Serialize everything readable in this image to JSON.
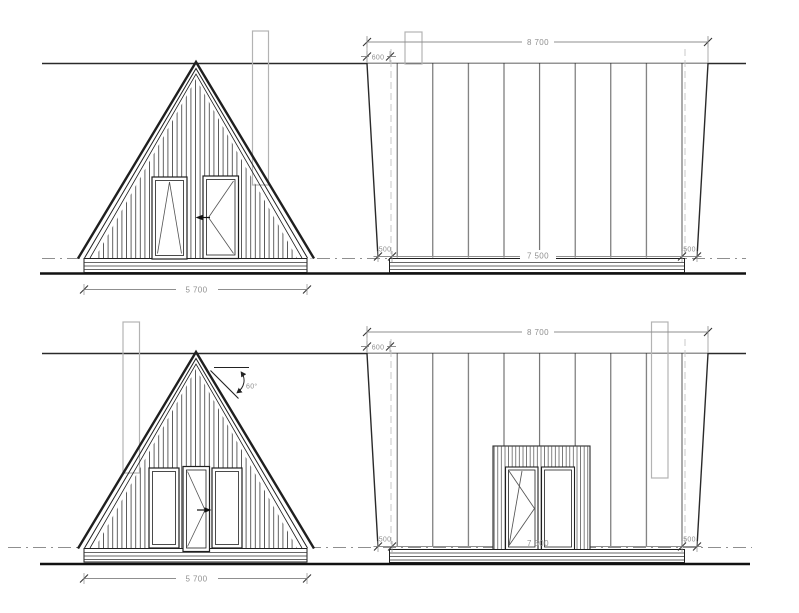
{
  "drawing_labels": {
    "front_width": "5 700",
    "side_overall_width": "8 700",
    "roof_overhang": "600",
    "side_offset": "500",
    "side_inner_width": "7 500",
    "roof_angle": "60°"
  },
  "palette": {
    "ink": "#1f1f1f",
    "dimension_text": "#8f8f8f",
    "chimney_outline": "#b3b3b3"
  }
}
